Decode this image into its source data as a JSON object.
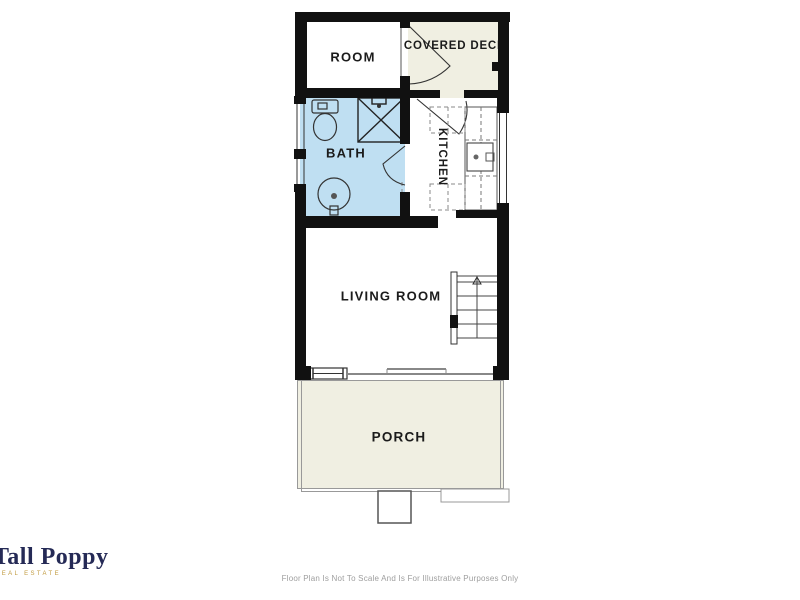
{
  "rooms": {
    "room": {
      "label": "ROOM"
    },
    "covered_deck": {
      "label": "COVERED DECK"
    },
    "bath": {
      "label": "BATH"
    },
    "kitchen": {
      "label": "KITCHEN"
    },
    "living_room": {
      "label": "LIVING ROOM"
    },
    "porch": {
      "label": "PORCH"
    }
  },
  "branding": {
    "name": "Tall Poppy",
    "tagline": "REAL ESTATE",
    "name_color": "#252a56",
    "tagline_color": "#c09a3e"
  },
  "footer": {
    "disclaimer": "Floor Plan Is Not To Scale And Is For Illustrative Purposes Only"
  },
  "colors": {
    "wall": "#111111",
    "bath_fill": "#bfdff2",
    "deck_fill": "#f0efe2",
    "porch_fill": "#f0efe2",
    "line": "#3a3a3a"
  }
}
